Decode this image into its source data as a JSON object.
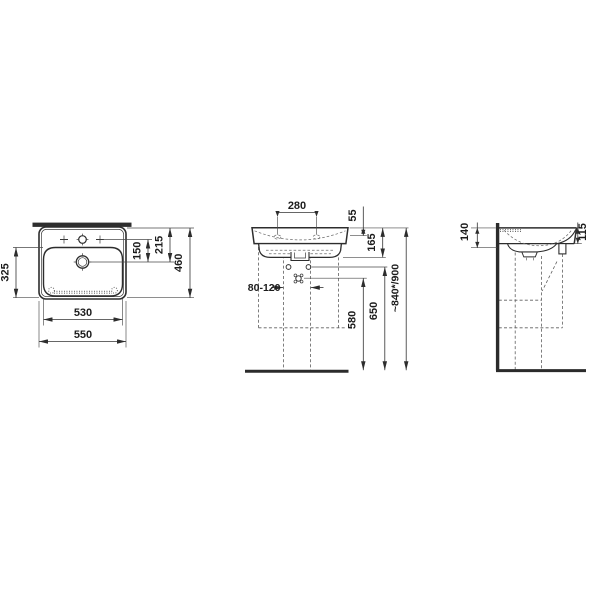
{
  "drawing": {
    "title": "Wall-mounted washbasin technical dimension drawing",
    "views": {
      "plan": "plan-view",
      "front": "front-view",
      "side": "side-view"
    }
  },
  "dimensions": {
    "overall_width": "550",
    "bowl_width": "530",
    "bowl_depth": "325",
    "taphole_to_drain": "150",
    "rim_to_drain": "215",
    "overall_depth": "460",
    "taphole_spacing": "280",
    "rim_to_fixing_holes": "55",
    "basin_height": "165",
    "supply_pipe_spacing": "80-120",
    "waste_outlet_height": "580",
    "supply_connection_height": "650",
    "installation_height": "~840*/900",
    "side_rear_height": "140",
    "side_front_height": "115"
  }
}
